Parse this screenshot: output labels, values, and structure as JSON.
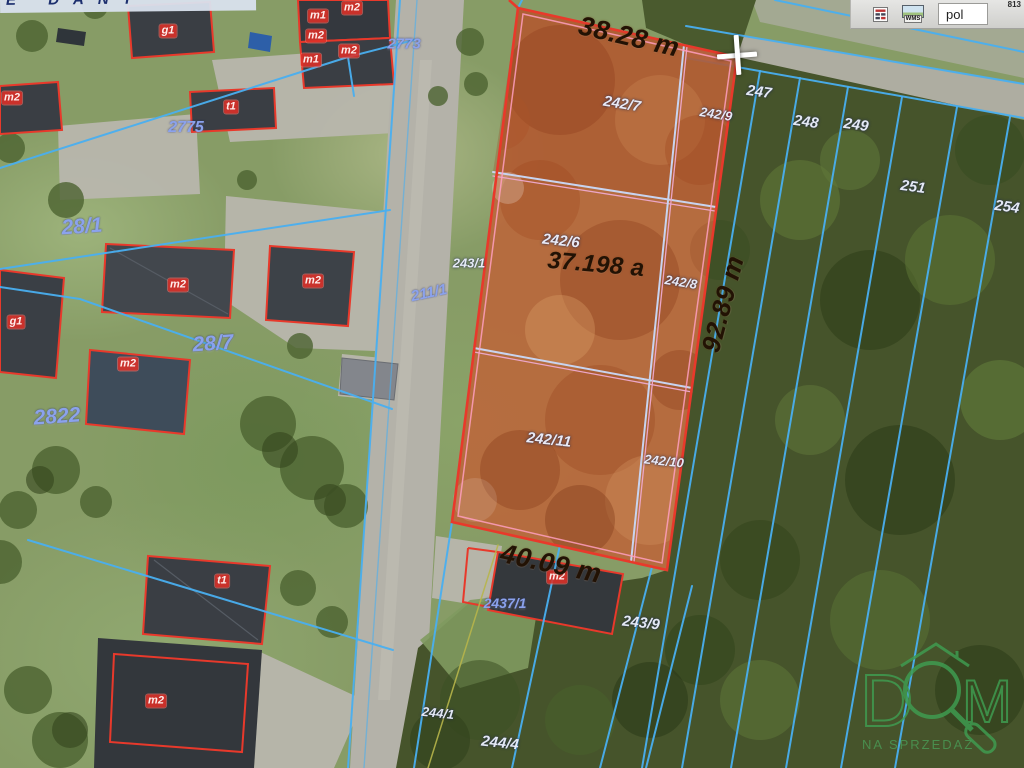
{
  "app": {
    "corner_number": "813"
  },
  "toolbar": {
    "wms_label": "WMS",
    "language": "pol"
  },
  "street_band": {
    "text": "E DANT"
  },
  "highlight": {
    "area_value": "37.198 a",
    "top_edge": "38.28 m",
    "right_edge": "92.89 m",
    "bottom_edge": "40.09 m",
    "fill_color": "#c06036",
    "outline_color": "#e8392b",
    "inner_line_color": "#ff9fc0"
  },
  "measurements": [
    {
      "text": "38.28 m",
      "x": 629,
      "y": 37,
      "rot": 13,
      "fs": 27
    },
    {
      "text": "37.198 a",
      "x": 596,
      "y": 265,
      "rot": 5,
      "fs": 24
    },
    {
      "text": "92.89 m",
      "x": 723,
      "y": 304,
      "rot": -75,
      "fs": 26
    },
    {
      "text": "40.09 m",
      "x": 551,
      "y": 564,
      "rot": 12,
      "fs": 27
    }
  ],
  "parcel_labels": {
    "white": [
      {
        "text": "242/7",
        "x": 622,
        "y": 104,
        "rot": 9
      },
      {
        "text": "242/9",
        "x": 716,
        "y": 114,
        "rot": 9,
        "fs": 13
      },
      {
        "text": "242/6",
        "x": 561,
        "y": 241,
        "rot": 6
      },
      {
        "text": "242/8",
        "x": 681,
        "y": 282,
        "rot": 9,
        "fs": 13
      },
      {
        "text": "242/11",
        "x": 549,
        "y": 440,
        "rot": 6
      },
      {
        "text": "242/10",
        "x": 664,
        "y": 461,
        "rot": 6,
        "fs": 13
      },
      {
        "text": "243/1",
        "x": 469,
        "y": 263,
        "rot": 0,
        "fs": 13
      },
      {
        "text": "247",
        "x": 759,
        "y": 92,
        "rot": 8
      },
      {
        "text": "248",
        "x": 806,
        "y": 122,
        "rot": 8
      },
      {
        "text": "249",
        "x": 856,
        "y": 125,
        "rot": 8
      },
      {
        "text": "251",
        "x": 913,
        "y": 187,
        "rot": 8
      },
      {
        "text": "254",
        "x": 1007,
        "y": 207,
        "rot": 8
      },
      {
        "text": "243/9",
        "x": 641,
        "y": 623,
        "rot": 6
      },
      {
        "text": "244/1",
        "x": 438,
        "y": 713,
        "rot": 6,
        "fs": 13
      },
      {
        "text": "244/4",
        "x": 500,
        "y": 743,
        "rot": 6
      }
    ],
    "blue": [
      {
        "text": "28/1",
        "x": 82,
        "y": 227,
        "rot": -4,
        "fs": 21
      },
      {
        "text": "28/7",
        "x": 213,
        "y": 344,
        "rot": -4,
        "fs": 21
      },
      {
        "text": "2822",
        "x": 57,
        "y": 417,
        "rot": -4,
        "fs": 21
      },
      {
        "text": "211/1",
        "x": 429,
        "y": 293,
        "rot": -12,
        "fs": 15
      },
      {
        "text": "2773",
        "x": 404,
        "y": 44,
        "rot": 0,
        "fs": 15
      },
      {
        "text": "2775",
        "x": 186,
        "y": 128,
        "rot": 0,
        "fs": 16
      },
      {
        "text": "2437/1",
        "x": 505,
        "y": 603,
        "rot": 0,
        "fs": 14
      }
    ]
  },
  "building_labels": [
    {
      "text": "g1",
      "x": 168,
      "y": 31
    },
    {
      "text": "t1",
      "x": 231,
      "y": 107
    },
    {
      "text": "m2",
      "x": 12,
      "y": 98
    },
    {
      "text": "m1",
      "x": 318,
      "y": 16
    },
    {
      "text": "m2",
      "x": 352,
      "y": 8
    },
    {
      "text": "m2",
      "x": 316,
      "y": 36
    },
    {
      "text": "m2",
      "x": 349,
      "y": 51
    },
    {
      "text": "m1",
      "x": 311,
      "y": 60
    },
    {
      "text": "m2",
      "x": 178,
      "y": 285
    },
    {
      "text": "m2",
      "x": 313,
      "y": 281
    },
    {
      "text": "g1",
      "x": 16,
      "y": 322
    },
    {
      "text": "m2",
      "x": 128,
      "y": 364
    },
    {
      "text": "t1",
      "x": 222,
      "y": 581
    },
    {
      "text": "m2",
      "x": 156,
      "y": 701
    },
    {
      "text": "m2",
      "x": 557,
      "y": 577
    }
  ],
  "logo": {
    "d": "D",
    "m": "M",
    "subtitle": "NA SPRZEDAŻ",
    "color": "#3f9b50"
  }
}
